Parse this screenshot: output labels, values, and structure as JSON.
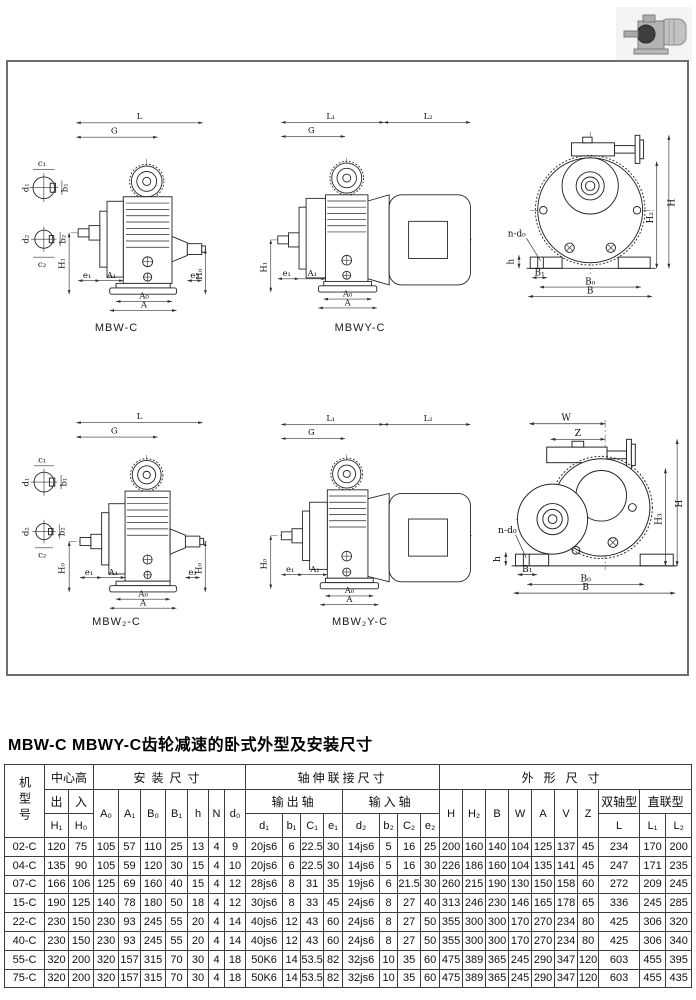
{
  "page": {
    "title": "MBW-C MBWY-C齿轮减速的卧式外型及安装尺寸"
  },
  "drawings": {
    "captions": {
      "mbw_c": "MBW-C",
      "mbwy_c": "MBWY-C",
      "mbw2_c": "MBW₂-C",
      "mbw2y_c": "MBW₂Y-C"
    },
    "labels": {
      "L": "L",
      "L1": "L₁",
      "L2": "L₂",
      "G": "G",
      "A": "A",
      "A0": "A₀",
      "A1": "A₁",
      "B": "B",
      "B0": "B₀",
      "B1": "B₁",
      "H": "H",
      "H0": "H₀",
      "H1": "H₁",
      "H2": "H₂",
      "H3": "H₃",
      "W": "W",
      "Z": "Z",
      "h": "h",
      "ndo": "n-d₀",
      "e1": "e₁",
      "e2": "e₂",
      "c1": "c₁",
      "c2": "c₂",
      "b1": "b₁",
      "b2": "b₂",
      "d1": "d₁",
      "d2": "d₂"
    }
  },
  "table": {
    "headers": {
      "model": "机型号",
      "center_height": "中心高",
      "install": "安装尺寸",
      "shaft": "轴伸联接尺寸",
      "outline": "外形尺寸",
      "out": "出",
      "in": "入",
      "output_shaft": "输出轴",
      "input_shaft": "输入轴",
      "twin": "双轴型",
      "direct": "直联型"
    },
    "cols_center": [
      "H₁",
      "H₀"
    ],
    "cols_install": [
      "A₀",
      "A₁",
      "B₀",
      "B₁",
      "h",
      "N",
      "d₀"
    ],
    "cols_output": [
      "d₁",
      "b₁",
      "C₁",
      "e₁"
    ],
    "cols_input": [
      "d₂",
      "b₂",
      "C₂",
      "e₂"
    ],
    "cols_outline": [
      "H",
      "H₂",
      "B",
      "W",
      "A",
      "V",
      "Z"
    ],
    "cols_L": [
      "L",
      "L₁",
      "L₂"
    ],
    "rows": [
      [
        "02-C",
        "120",
        "75",
        "105",
        "57",
        "110",
        "25",
        "13",
        "4",
        "9",
        "20js6",
        "6",
        "22.5",
        "30",
        "14js6",
        "5",
        "16",
        "25",
        "200",
        "160",
        "140",
        "104",
        "125",
        "137",
        "45",
        "234",
        "170",
        "200"
      ],
      [
        "04-C",
        "135",
        "90",
        "105",
        "59",
        "120",
        "30",
        "15",
        "4",
        "10",
        "20js6",
        "6",
        "22.5",
        "30",
        "14js6",
        "5",
        "16",
        "30",
        "226",
        "186",
        "160",
        "104",
        "135",
        "141",
        "45",
        "247",
        "171",
        "235"
      ],
      [
        "07-C",
        "166",
        "106",
        "125",
        "69",
        "160",
        "40",
        "15",
        "4",
        "12",
        "28js6",
        "8",
        "31",
        "35",
        "19js6",
        "6",
        "21.5",
        "30",
        "260",
        "215",
        "190",
        "130",
        "150",
        "158",
        "60",
        "272",
        "209",
        "245"
      ],
      [
        "15-C",
        "190",
        "125",
        "140",
        "78",
        "180",
        "50",
        "18",
        "4",
        "12",
        "30js6",
        "8",
        "33",
        "45",
        "24js6",
        "8",
        "27",
        "40",
        "313",
        "246",
        "230",
        "146",
        "165",
        "178",
        "65",
        "336",
        "245",
        "285"
      ],
      [
        "22-C",
        "230",
        "150",
        "230",
        "93",
        "245",
        "55",
        "20",
        "4",
        "14",
        "40js6",
        "12",
        "43",
        "60",
        "24js6",
        "8",
        "27",
        "50",
        "355",
        "300",
        "300",
        "170",
        "270",
        "234",
        "80",
        "425",
        "306",
        "320"
      ],
      [
        "40-C",
        "230",
        "150",
        "230",
        "93",
        "245",
        "55",
        "20",
        "4",
        "14",
        "40js6",
        "12",
        "43",
        "60",
        "24js6",
        "8",
        "27",
        "50",
        "355",
        "300",
        "300",
        "170",
        "270",
        "234",
        "80",
        "425",
        "306",
        "340"
      ],
      [
        "55-C",
        "320",
        "200",
        "320",
        "157",
        "315",
        "70",
        "30",
        "4",
        "18",
        "50K6",
        "14",
        "53.5",
        "82",
        "32js6",
        "10",
        "35",
        "60",
        "475",
        "389",
        "365",
        "245",
        "290",
        "347",
        "120",
        "603",
        "455",
        "395"
      ],
      [
        "75-C",
        "320",
        "200",
        "320",
        "157",
        "315",
        "70",
        "30",
        "4",
        "18",
        "50K6",
        "14",
        "53.5",
        "82",
        "32js6",
        "10",
        "35",
        "60",
        "475",
        "389",
        "365",
        "245",
        "290",
        "347",
        "120",
        "603",
        "455",
        "435"
      ]
    ]
  }
}
